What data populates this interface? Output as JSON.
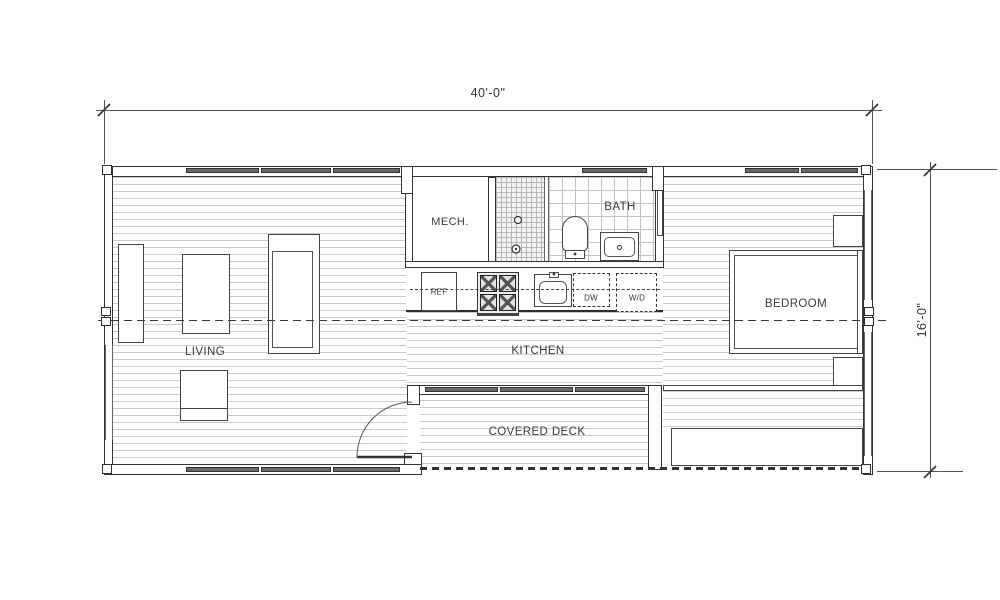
{
  "drawing": {
    "dim_width": "40'-0\"",
    "dim_height": "16'-0\""
  },
  "rooms": {
    "living": "LIVING",
    "kitchen": "KITCHEN",
    "mech": "MECH.",
    "bath": "BATH",
    "bedroom": "BEDROOM",
    "deck": "COVERED DECK"
  },
  "appliances": {
    "ref": "REF",
    "dw": "DW",
    "wd": "W/D"
  },
  "colors": {
    "wall": "#333333",
    "floor_line": "#cbcbcb",
    "glazing": "#6a6a6a",
    "text": "#3a3a3a",
    "background": "#ffffff"
  }
}
